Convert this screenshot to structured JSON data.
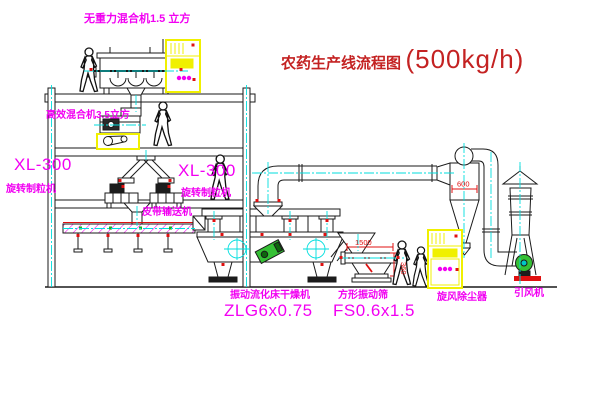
{
  "title": {
    "text": "农药生产线流程图",
    "capacity": "(500kg/h)"
  },
  "labels": {
    "mixer_top": "无重力混合机1.5 立方",
    "mixer_mid": "高效混合机3.5立方",
    "xl300_left": "XL-300",
    "granulator_left": "旋转制粒机",
    "xl300_right": "XL-300",
    "granulator_right": "旋转制粒机",
    "belt_conveyor": "皮带输送机",
    "dryer_name": "振动流化床干燥机",
    "dryer_model": "ZLG6x0.75",
    "screen_name": "方形振动筛",
    "screen_model": "FS0.6x1.5",
    "cyclone": "旋风除尘器",
    "fan": "引风机"
  },
  "dimensions": {
    "screen_length": "1500",
    "screen_height": "360",
    "cyclone_width": "600"
  },
  "colors": {
    "line": "#1a1a1a",
    "centerline_cyan": "#00dede",
    "label_magenta": "#f200f2",
    "title_red": "#c42222",
    "dimension_red": "#e01010",
    "cabinet_yellow": "#f0f000",
    "motor_green": "#35c035"
  }
}
